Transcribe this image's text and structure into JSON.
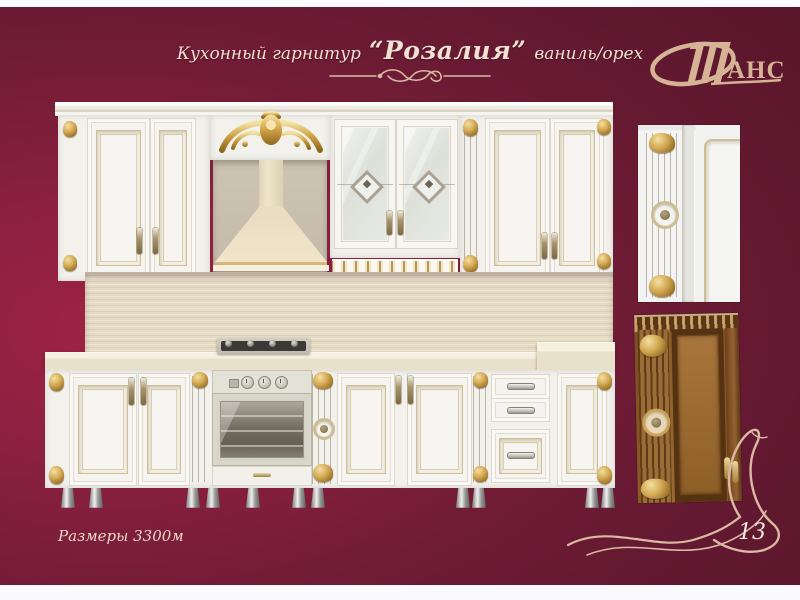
{
  "page": {
    "page_number": "13",
    "colors": {
      "background_maroon": "#6b1c34",
      "bright_backdrop": "#9e2244",
      "accent_cream": "#e9d6c4",
      "gold": "#c9a24a",
      "edge_strip": "#fbfafc"
    }
  },
  "header": {
    "title_prefix": "Кухонный гарнитур",
    "product_name": "“Розалия”",
    "title_suffix": "ваниль/орех"
  },
  "logo": {
    "initial": "Ш",
    "rest": "АНС"
  },
  "footer": {
    "dimensions_label": "Размеры 3300м"
  }
}
